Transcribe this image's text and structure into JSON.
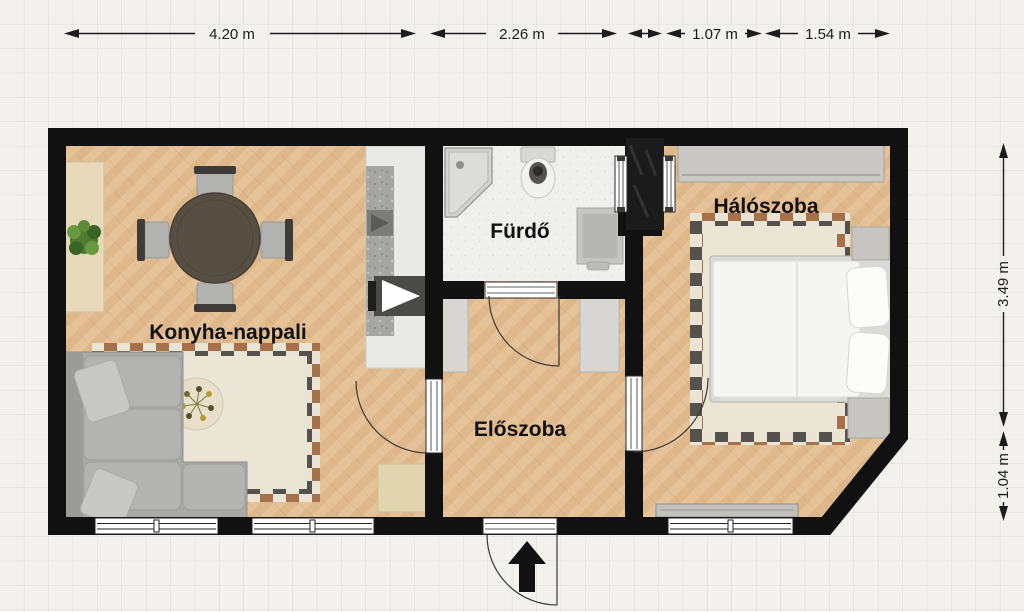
{
  "floorplan": {
    "rooms": {
      "living": {
        "name": "Konyha-nappali"
      },
      "bath": {
        "name": "Fürdő"
      },
      "hall": {
        "name": "Előszoba"
      },
      "bedroom": {
        "name": "Hálószoba"
      }
    },
    "dimensions": {
      "top": [
        "4.20 m",
        "2.26 m",
        "1.07 m",
        "1.54 m"
      ],
      "right": [
        "3.49 m",
        "1.04 m"
      ]
    },
    "icons": {
      "entrance": "arrow-up-icon"
    },
    "colors": {
      "wall": "#111111",
      "wood_floor": "#e4bf95",
      "bath_tile": "#efefed",
      "rug_cream": "#e9e4d3",
      "checker_brown": "#a5704a",
      "checker_gray": "#55524e",
      "furniture_gray": "#ababa9"
    }
  }
}
